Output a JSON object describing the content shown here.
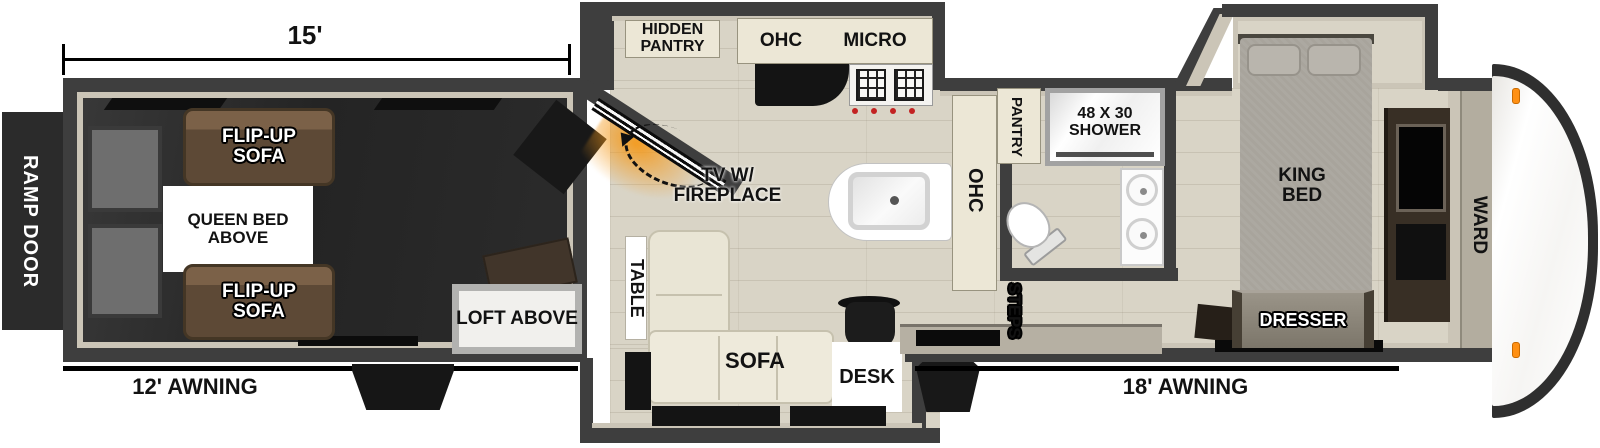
{
  "exterior": {
    "dimension_garage": "15'",
    "ramp_door": "RAMP DOOR",
    "awning_left": "12' AWNING",
    "awning_right": "18' AWNING"
  },
  "garage": {
    "flip_up_sofa_top": "FLIP-UP SOFA",
    "queen_bed_above": "QUEEN BED ABOVE",
    "flip_up_sofa_bottom": "FLIP-UP SOFA",
    "loft_above": "LOFT ABOVE"
  },
  "kitchen": {
    "hidden_pantry": "HIDDEN PANTRY",
    "ohc_top": "OHC",
    "micro": "MICRO",
    "tv_fireplace": "TV W/ FIREPLACE",
    "ohc_side": "OHC",
    "pantry": "PANTRY"
  },
  "living": {
    "table": "TABLE",
    "sofa": "SOFA",
    "desk": "DESK",
    "steps": "STEPS"
  },
  "bathroom": {
    "shower": "48 X 30 SHOWER"
  },
  "bedroom": {
    "king_bed": "KING BED",
    "dresser": "DRESSER",
    "ward": "WARD"
  },
  "colors": {
    "wall": "#3e3e3e",
    "wall_lining": "#cbc5b7",
    "floor": "#d9d4c6",
    "garage_floor": "#262626",
    "cabinet_cream": "#ece7d6",
    "sofa_brown": "#5d4936",
    "sofa_cream": "#e9e5d5",
    "bed_gray": "#a8a49c",
    "fireplace_orange": "#f4991a",
    "marker_light_orange": "#ff9013",
    "line_black": "#000000"
  }
}
